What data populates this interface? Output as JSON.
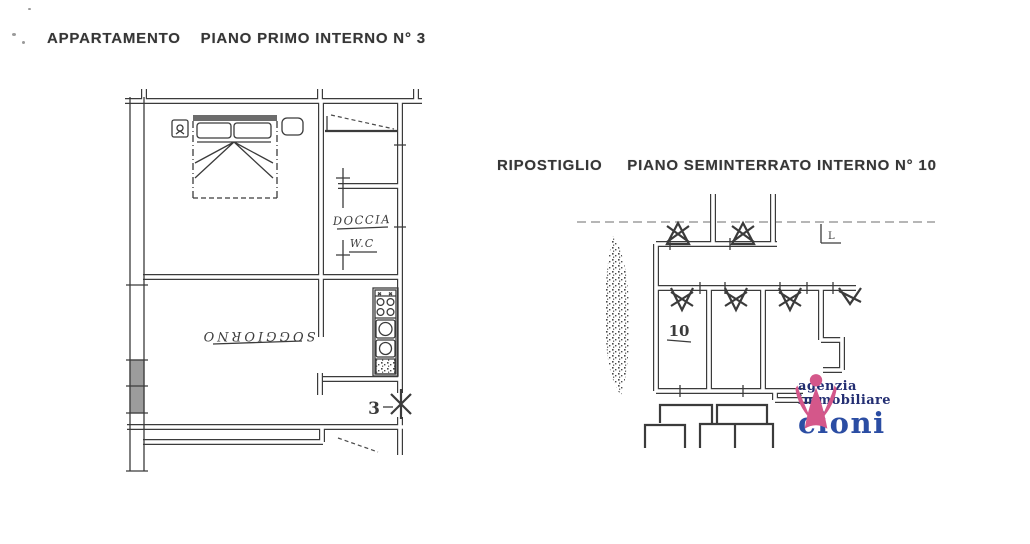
{
  "titles": {
    "apartment": "APPARTAMENTO    PIANO PRIMO INTERNO N° 3",
    "storage": "RIPOSTIGLIO     PIANO SEMINTERRATO INTERNO N° 10"
  },
  "apartment_plan": {
    "rooms": {
      "shower_label": "DOCCIA",
      "wc_label": "W.C",
      "living_label": "SOGGIORNO",
      "door_number": "3"
    }
  },
  "storage_plan": {
    "unit_label": "10",
    "corner_letter": "L"
  },
  "logo": {
    "line1": "agenzia",
    "line2": "immobiliare",
    "name": "cioni",
    "colors": {
      "figure": "#d4578a",
      "text_dark": "#232e72",
      "text_name": "#2b4da3"
    }
  },
  "ink_color": "#3b3b3b"
}
